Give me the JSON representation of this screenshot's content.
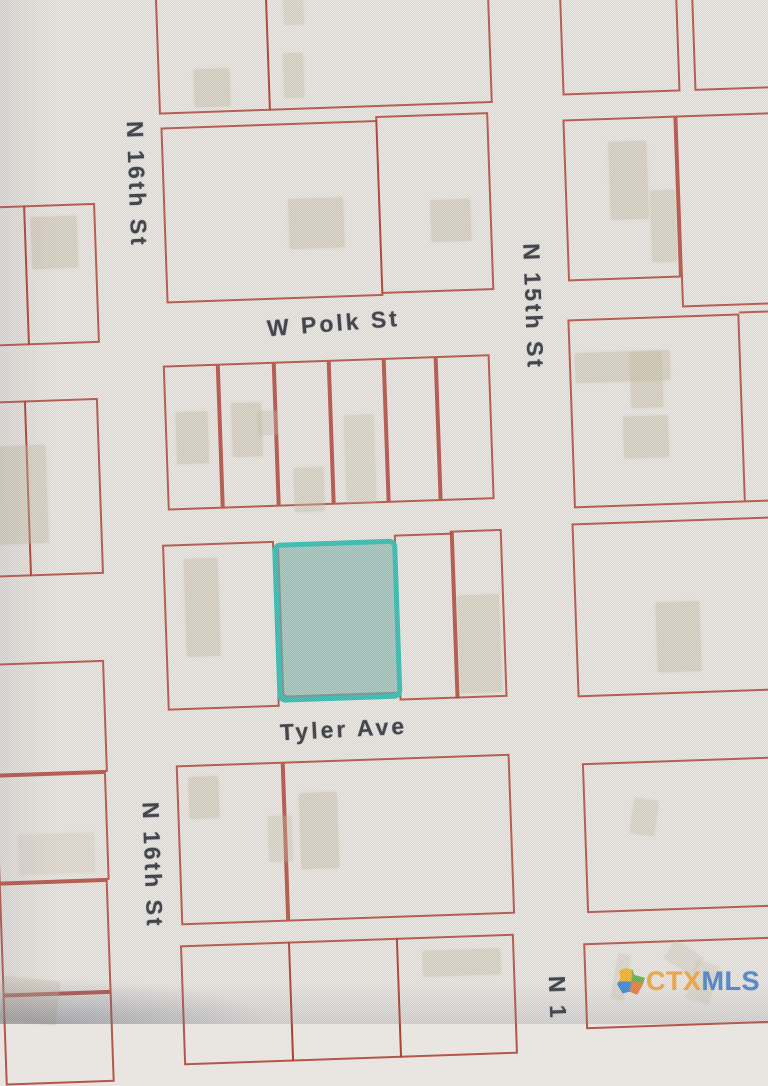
{
  "map": {
    "background_color": "#e9e6e1",
    "parcel_line_color": "#ac3d2f",
    "building_fill_color": "#c7bca4",
    "rotation_deg": -2,
    "labels": [
      {
        "text": "N 16th St",
        "x": 148,
        "y": 176,
        "rot": 90,
        "size": 23
      },
      {
        "text": "N 15th St",
        "x": 540,
        "y": 312,
        "rot": 90,
        "size": 23
      },
      {
        "text": "W Polk St",
        "x": 340,
        "y": 322,
        "rot": -2.5,
        "size": 23
      },
      {
        "text": "Tyler Ave",
        "x": 336,
        "y": 728,
        "rot": -1,
        "size": 23
      },
      {
        "text": "N 16th St",
        "x": 140,
        "y": 857,
        "rot": 90,
        "size": 23
      },
      {
        "text": "N 1",
        "x": 540,
        "y": 1004,
        "rot": 90,
        "size": 23
      }
    ],
    "streets": [
      "N 16th St",
      "N 15th St",
      "W Polk St",
      "Tyler Ave"
    ],
    "highlight": {
      "x": 271,
      "y": 539,
      "w": 125,
      "h": 160,
      "fill": "#96beb4",
      "border": "#3abdb1"
    },
    "parcels": [
      {
        "x": -14,
        "y": 193,
        "w": 50,
        "h": 140
      },
      {
        "x": 34,
        "y": 193,
        "w": 72,
        "h": 140
      },
      {
        "x": -14,
        "y": 388,
        "w": 44,
        "h": 176
      },
      {
        "x": 28,
        "y": 388,
        "w": 74,
        "h": 176
      },
      {
        "x": -14,
        "y": 650,
        "w": 113,
        "h": 112
      },
      {
        "x": -14,
        "y": 762,
        "w": 111,
        "h": 108
      },
      {
        "x": -14,
        "y": 870,
        "w": 109,
        "h": 112
      },
      {
        "x": -14,
        "y": 982,
        "w": 109,
        "h": 90
      },
      {
        "x": 173,
        "y": -20,
        "w": 112,
        "h": 127
      },
      {
        "x": 283,
        "y": -20,
        "w": 224,
        "h": 127
      },
      {
        "x": 174,
        "y": 120,
        "w": 217,
        "h": 176
      },
      {
        "x": 389,
        "y": 116,
        "w": 113,
        "h": 178
      },
      {
        "x": 168,
        "y": 358,
        "w": 55,
        "h": 145
      },
      {
        "x": 223,
        "y": 358,
        "w": 56,
        "h": 145
      },
      {
        "x": 279,
        "y": 358,
        "w": 55,
        "h": 145
      },
      {
        "x": 334,
        "y": 358,
        "w": 55,
        "h": 145
      },
      {
        "x": 389,
        "y": 358,
        "w": 52,
        "h": 145
      },
      {
        "x": 441,
        "y": 358,
        "w": 54,
        "h": 145
      },
      {
        "x": 161,
        "y": 537,
        "w": 112,
        "h": 166
      },
      {
        "x": 393,
        "y": 535,
        "w": 60,
        "h": 166
      },
      {
        "x": 449,
        "y": 533,
        "w": 52,
        "h": 168
      },
      {
        "x": 167,
        "y": 758,
        "w": 107,
        "h": 160
      },
      {
        "x": 274,
        "y": 758,
        "w": 227,
        "h": 160
      },
      {
        "x": 165,
        "y": 938,
        "w": 110,
        "h": 120
      },
      {
        "x": 273,
        "y": 938,
        "w": 110,
        "h": 120
      },
      {
        "x": 381,
        "y": 938,
        "w": 118,
        "h": 120
      },
      {
        "x": 577,
        "y": -20,
        "w": 118,
        "h": 122
      },
      {
        "x": 709,
        "y": -20,
        "w": 97,
        "h": 122
      },
      {
        "x": 576,
        "y": 126,
        "w": 113,
        "h": 162
      },
      {
        "x": 689,
        "y": 126,
        "w": 104,
        "h": 192
      },
      {
        "x": 574,
        "y": 326,
        "w": 172,
        "h": 189
      },
      {
        "x": 571,
        "y": 530,
        "w": 224,
        "h": 174
      },
      {
        "x": 573,
        "y": 770,
        "w": 224,
        "h": 150
      },
      {
        "x": 568,
        "y": 950,
        "w": 228,
        "h": 86
      }
    ],
    "segments": [
      {
        "x": 746,
        "y": 324,
        "w": 46,
        "h": 2
      },
      {
        "x": 746,
        "y": 513,
        "w": 46,
        "h": 2
      }
    ],
    "buildings": [
      {
        "x": 41,
        "y": 205,
        "w": 46,
        "h": 52,
        "o": 0.5,
        "r": 0
      },
      {
        "x": -8,
        "y": 433,
        "w": 56,
        "h": 98,
        "o": 0.45,
        "r": 0
      },
      {
        "x": 7,
        "y": 822,
        "w": 76,
        "h": 40,
        "o": 0.28,
        "r": 0
      },
      {
        "x": -15,
        "y": 966,
        "w": 56,
        "h": 44,
        "o": 0.4,
        "r": 8
      },
      {
        "x": 209,
        "y": 63,
        "w": 36,
        "h": 38,
        "o": 0.5,
        "r": 0
      },
      {
        "x": 299,
        "y": 50,
        "w": 20,
        "h": 45,
        "o": 0.45,
        "r": 0
      },
      {
        "x": 301,
        "y": -12,
        "w": 20,
        "h": 34,
        "o": 0.4,
        "r": 0
      },
      {
        "x": 299,
        "y": 196,
        "w": 55,
        "h": 50,
        "o": 0.5,
        "r": 0
      },
      {
        "x": 441,
        "y": 202,
        "w": 40,
        "h": 42,
        "o": 0.5,
        "r": 0
      },
      {
        "x": 179,
        "y": 405,
        "w": 32,
        "h": 52,
        "o": 0.5,
        "r": 0
      },
      {
        "x": 235,
        "y": 398,
        "w": 30,
        "h": 54,
        "o": 0.5,
        "r": 0
      },
      {
        "x": 261,
        "y": 407,
        "w": 20,
        "h": 24,
        "o": 0.4,
        "r": 0
      },
      {
        "x": 295,
        "y": 465,
        "w": 30,
        "h": 44,
        "o": 0.45,
        "r": 0
      },
      {
        "x": 347,
        "y": 414,
        "w": 30,
        "h": 88,
        "o": 0.4,
        "r": 0
      },
      {
        "x": 182,
        "y": 552,
        "w": 34,
        "h": 98,
        "o": 0.5,
        "r": 0
      },
      {
        "x": 454,
        "y": 598,
        "w": 42,
        "h": 98,
        "o": 0.45,
        "r": 0
      },
      {
        "x": 179,
        "y": 770,
        "w": 30,
        "h": 42,
        "o": 0.5,
        "r": 0
      },
      {
        "x": 289,
        "y": 790,
        "w": 38,
        "h": 76,
        "o": 0.5,
        "r": 0
      },
      {
        "x": 257,
        "y": 812,
        "w": 24,
        "h": 46,
        "o": 0.4,
        "r": 0
      },
      {
        "x": 407,
        "y": 952,
        "w": 78,
        "h": 26,
        "o": 0.45,
        "r": 0
      },
      {
        "x": 621,
        "y": 150,
        "w": 38,
        "h": 78,
        "o": 0.5,
        "r": 0
      },
      {
        "x": 661,
        "y": 200,
        "w": 25,
        "h": 72,
        "o": 0.45,
        "r": 0
      },
      {
        "x": 580,
        "y": 360,
        "w": 95,
        "h": 30,
        "o": 0.5,
        "r": 0
      },
      {
        "x": 635,
        "y": 361,
        "w": 32,
        "h": 56,
        "o": 0.5,
        "r": 0
      },
      {
        "x": 626,
        "y": 425,
        "w": 45,
        "h": 42,
        "o": 0.5,
        "r": 0
      },
      {
        "x": 652,
        "y": 612,
        "w": 44,
        "h": 70,
        "o": 0.5,
        "r": 0
      },
      {
        "x": 621,
        "y": 808,
        "w": 25,
        "h": 36,
        "o": 0.4,
        "r": 10
      },
      {
        "x": 598,
        "y": 962,
        "w": 13,
        "h": 46,
        "o": 0.35,
        "r": 12
      },
      {
        "x": 651,
        "y": 957,
        "w": 34,
        "h": 22,
        "o": 0.3,
        "r": 35
      },
      {
        "x": 674,
        "y": 973,
        "w": 24,
        "h": 40,
        "o": 0.3,
        "r": 18
      }
    ]
  },
  "watermark": {
    "prefix": "CTX",
    "suffix": "MLS",
    "prefix_color": "#f0a035",
    "suffix_color": "#3d79c6",
    "icon": "texas-state-multicolor-icon"
  }
}
